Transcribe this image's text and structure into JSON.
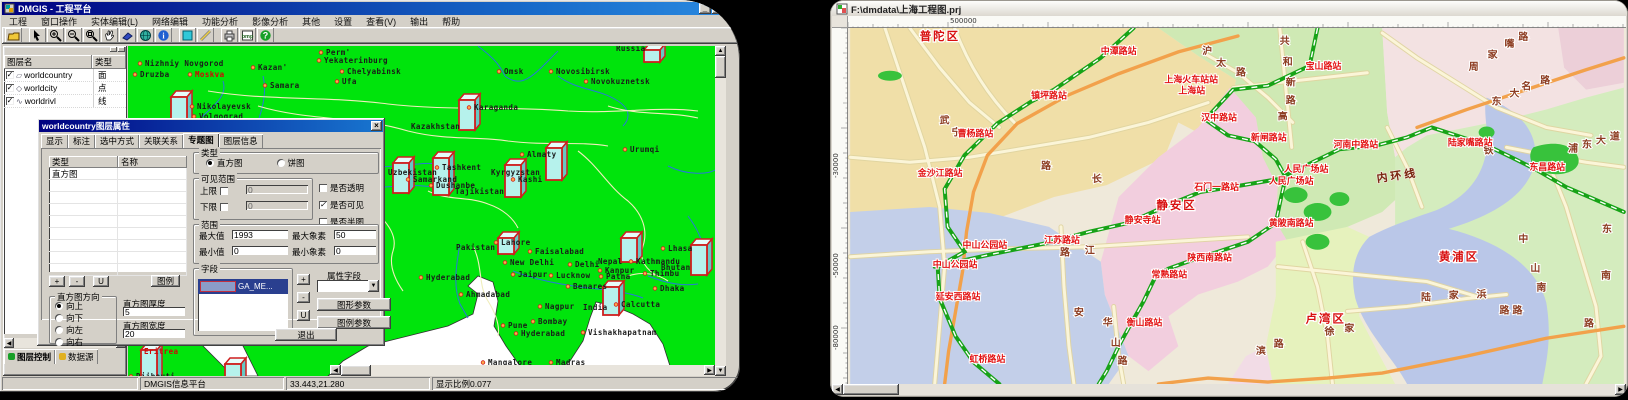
{
  "colors": {
    "land_green": "#00e40c",
    "titlebar_blue": "#000080",
    "station_red": "#e31212",
    "district_red": "#d80f0f",
    "metro_green": "#17a317",
    "orange_road": "#f2a14b",
    "column_cyan": "#b6f2ec",
    "column_border": "#cf1f1f"
  },
  "left_window": {
    "title": "DMGIS - 工程平台",
    "window_buttons": [
      "_",
      "□"
    ],
    "menus": [
      "工程",
      "窗口操作",
      "实体编辑(L)",
      "网络编辑",
      "功能分析",
      "影像分析",
      "其他",
      "设置",
      "查看(V)",
      "输出",
      "帮助"
    ],
    "toolbar_icons": [
      "open-folder",
      "select-arrow",
      "zoom-in",
      "zoom-out",
      "zoom-window",
      "pan-hand",
      "eraser-wedge",
      "globe",
      "info",
      "fill-rect",
      "measure-pencil",
      "print",
      "export-bmp",
      "help"
    ],
    "layer_panel": {
      "columns": [
        "图层名",
        "类型"
      ],
      "rows": [
        {
          "checked": true,
          "icon": "polygon-icon",
          "name": "worldcountry",
          "type": "面"
        },
        {
          "checked": true,
          "icon": "point-icon",
          "name": "worldcity",
          "type": "点"
        },
        {
          "checked": true,
          "icon": "line-icon",
          "name": "worldrivl",
          "type": "线"
        }
      ],
      "tabs": [
        {
          "label": "图层控制",
          "active": true
        },
        {
          "label": "数据源",
          "active": false
        }
      ]
    },
    "status": {
      "app": "DMGIS信息平台",
      "coords": "33.443,21.280",
      "scale": "显示比例0.077"
    },
    "dialog": {
      "title": "worldcountry图层属性",
      "close": "×",
      "tabs": [
        "显示",
        "标注",
        "选中方式",
        "关联关系",
        "专题图",
        "图层信息"
      ],
      "active_tab_index": 4,
      "list": {
        "col1": "类型",
        "col2": "名称",
        "row1": "直方图"
      },
      "type_group": {
        "label": "类型",
        "options": [
          "直方图",
          "饼图"
        ],
        "selected": 0
      },
      "visible_group": {
        "label": "可见范围",
        "upper": "上限",
        "lower": "下限",
        "upper_val": "0",
        "lower_val": "0"
      },
      "flags": [
        {
          "label": "是否透明",
          "checked": false
        },
        {
          "label": "是否可见",
          "checked": true
        },
        {
          "label": "是否半图",
          "checked": false
        }
      ],
      "range_group": {
        "label": "范围",
        "max_label": "最大值",
        "max_val": "1993",
        "maxpix_label": "最大象素",
        "maxpix_val": "50",
        "min_label": "最小值",
        "min_val": "0",
        "minpix_label": "最小象素",
        "minpix_val": "0"
      },
      "small_buttons": [
        "+",
        "-",
        "U"
      ],
      "legend_btn": "图例",
      "dir_group": {
        "label": "直方图方向",
        "options": [
          "向上",
          "向下",
          "向左",
          "向右"
        ],
        "selected": 0
      },
      "thickness": {
        "label": "直方图厚度",
        "val": "5"
      },
      "bar_width": {
        "label": "直方图宽度",
        "val": "20"
      },
      "field_group": {
        "label": "字段",
        "selected_item": "GA_ME..."
      },
      "field_buttons": [
        "+",
        "-",
        "U"
      ],
      "attr_field_label": "属性字段",
      "param_buttons": [
        "图形参数",
        "图例参数"
      ],
      "exit_btn": "退出"
    },
    "map": {
      "cities": [
        {
          "t": "Russia",
          "x": 488,
          "y": 5,
          "dot": false
        },
        {
          "t": "Nizhniy Novgorod",
          "x": 17,
          "y": 20,
          "dot": true
        },
        {
          "t": "Druzba",
          "x": 12,
          "y": 31,
          "dot": true
        },
        {
          "t": "Moskva",
          "x": 67,
          "y": 31,
          "dot": true,
          "red": true
        },
        {
          "t": "Kazan'",
          "x": 130,
          "y": 24,
          "dot": true
        },
        {
          "t": "Samara",
          "x": 142,
          "y": 42,
          "dot": true
        },
        {
          "t": "Perm'",
          "x": 198,
          "y": 9,
          "dot": true
        },
        {
          "t": "Yekaterinburg",
          "x": 196,
          "y": 17,
          "dot": true
        },
        {
          "t": "Chelyabinsk",
          "x": 219,
          "y": 28,
          "dot": true
        },
        {
          "t": "Ufa",
          "x": 214,
          "y": 38,
          "dot": true
        },
        {
          "t": "Nikolayevsk",
          "x": 69,
          "y": 63,
          "dot": true
        },
        {
          "t": "Volgograd",
          "x": 71,
          "y": 73,
          "dot": true
        },
        {
          "t": "Omsk",
          "x": 376,
          "y": 28,
          "dot": true
        },
        {
          "t": "Novosibirsk",
          "x": 428,
          "y": 28,
          "dot": true
        },
        {
          "t": "Novokuznetsk",
          "x": 463,
          "y": 38,
          "dot": true
        },
        {
          "t": "Karaganda",
          "x": 346,
          "y": 64,
          "dot": true
        },
        {
          "t": "Kazakhstan",
          "x": 283,
          "y": 83,
          "dot": false
        },
        {
          "t": "Almaty",
          "x": 399,
          "y": 111,
          "dot": true
        },
        {
          "t": "Urumqi",
          "x": 502,
          "y": 106,
          "dot": true
        },
        {
          "t": "Tashkent",
          "x": 314,
          "y": 124,
          "dot": true
        },
        {
          "t": "Samarkand",
          "x": 285,
          "y": 136,
          "dot": true
        },
        {
          "t": "Dushanbe",
          "x": 308,
          "y": 142,
          "dot": true
        },
        {
          "t": "Tajikistan",
          "x": 327,
          "y": 148,
          "dot": false
        },
        {
          "t": "Kyrgyzstan",
          "x": 363,
          "y": 129,
          "dot": false
        },
        {
          "t": "Kashi",
          "x": 390,
          "y": 136,
          "dot": true
        },
        {
          "t": "Uzbekistan",
          "x": 260,
          "y": 129,
          "dot": false
        },
        {
          "t": "Pakistan",
          "x": 328,
          "y": 204,
          "dot": false
        },
        {
          "t": "Lahore",
          "x": 373,
          "y": 199,
          "dot": true
        },
        {
          "t": "Faisalabad",
          "x": 407,
          "y": 208,
          "dot": true
        },
        {
          "t": "New Delhi",
          "x": 382,
          "y": 219,
          "dot": true
        },
        {
          "t": "Delhi",
          "x": 447,
          "y": 221,
          "dot": true
        },
        {
          "t": "Jaipur",
          "x": 390,
          "y": 231,
          "dot": true
        },
        {
          "t": "Lucknow",
          "x": 428,
          "y": 232,
          "dot": true
        },
        {
          "t": "Kanpur",
          "x": 477,
          "y": 227,
          "dot": true
        },
        {
          "t": "Patna",
          "x": 478,
          "y": 233,
          "dot": true
        },
        {
          "t": "Hyderabad",
          "x": 298,
          "y": 234,
          "dot": true
        },
        {
          "t": "Ahmadabad",
          "x": 338,
          "y": 251,
          "dot": true
        },
        {
          "t": "Nagpur",
          "x": 417,
          "y": 263,
          "dot": true
        },
        {
          "t": "India",
          "x": 455,
          "y": 264,
          "dot": false
        },
        {
          "t": "Calcutta",
          "x": 493,
          "y": 261,
          "dot": true
        },
        {
          "t": "Benares",
          "x": 445,
          "y": 243,
          "dot": true
        },
        {
          "t": "Bombay",
          "x": 410,
          "y": 278,
          "dot": true
        },
        {
          "t": "Pune",
          "x": 380,
          "y": 282,
          "dot": true
        },
        {
          "t": "Hyderabad",
          "x": 393,
          "y": 290,
          "dot": true
        },
        {
          "t": "Vishakhapatnam",
          "x": 460,
          "y": 289,
          "dot": true
        },
        {
          "t": "Mangalore",
          "x": 360,
          "y": 319,
          "dot": true
        },
        {
          "t": "Madras",
          "x": 428,
          "y": 319,
          "dot": true
        },
        {
          "t": "Bangalore",
          "x": 385,
          "y": 329,
          "dot": true
        },
        {
          "t": "Lhasa",
          "x": 540,
          "y": 205,
          "dot": true
        },
        {
          "t": "Bhutan",
          "x": 533,
          "y": 224,
          "dot": false
        },
        {
          "t": "Thimbu",
          "x": 522,
          "y": 230,
          "dot": true
        },
        {
          "t": "Dhaka",
          "x": 532,
          "y": 245,
          "dot": true
        },
        {
          "t": "Kathmandu",
          "x": 508,
          "y": 218,
          "dot": true
        },
        {
          "t": "Nepal",
          "x": 470,
          "y": 218,
          "dot": false
        },
        {
          "t": "Asmara",
          "x": 22,
          "y": 297,
          "dot": true
        },
        {
          "t": "Eritrea",
          "x": 16,
          "y": 308,
          "dot": false,
          "red": true
        },
        {
          "t": "Djibouti",
          "x": 8,
          "y": 333,
          "dot": true
        }
      ],
      "columns": [
        {
          "x": 43,
          "y": 51,
          "h": 33
        },
        {
          "x": 331,
          "y": 54,
          "h": 30
        },
        {
          "x": 305,
          "y": 112,
          "h": 37
        },
        {
          "x": 418,
          "y": 102,
          "h": 32
        },
        {
          "x": 377,
          "y": 119,
          "h": 32
        },
        {
          "x": 265,
          "y": 117,
          "h": 30
        },
        {
          "x": 493,
          "y": 192,
          "h": 24
        },
        {
          "x": 563,
          "y": 199,
          "h": 30
        },
        {
          "x": 475,
          "y": 241,
          "h": 28
        },
        {
          "x": 370,
          "y": 192,
          "h": 16
        },
        {
          "x": 516,
          "y": 4,
          "h": 12
        },
        {
          "x": 13,
          "y": 304,
          "h": 36
        },
        {
          "x": 97,
          "y": 318,
          "h": 22
        },
        {
          "x": 0,
          "y": 228,
          "h": 40,
          "w": 5
        }
      ]
    }
  },
  "right_window": {
    "title": "F:\\dmdata\\上海工程图.prj",
    "ruler": {
      "h_label": "500000",
      "h_label_x": 102,
      "v_labels": [
        {
          "t": "-30000",
          "y": 150
        },
        {
          "t": "-50000",
          "y": 250
        },
        {
          "t": "-80000",
          "y": 322
        }
      ]
    },
    "map": {
      "districts": [
        {
          "t": "普陀区",
          "x": 70,
          "y": 12
        },
        {
          "t": "静安区",
          "x": 308,
          "y": 182
        },
        {
          "t": "黄浦区",
          "x": 592,
          "y": 234
        },
        {
          "t": "卢湾区",
          "x": 458,
          "y": 296
        }
      ],
      "ring_labels": [
        {
          "t": "内环线",
          "x": 530,
          "y": 155
        }
      ],
      "stations": [
        {
          "t": "中潭路站",
          "x": 252,
          "y": 26
        },
        {
          "t": "镇坪路站",
          "x": 182,
          "y": 71
        },
        {
          "t": "曹杨路站",
          "x": 108,
          "y": 109
        },
        {
          "t": "金沙江路站",
          "x": 68,
          "y": 149
        },
        {
          "t": "中山公园站",
          "x": 113,
          "y": 221
        },
        {
          "t": "中山公园站",
          "x": 83,
          "y": 241
        },
        {
          "t": "延安西路站",
          "x": 86,
          "y": 273
        },
        {
          "t": "虹桥路站",
          "x": 120,
          "y": 336
        },
        {
          "t": "上海火车站站",
          "x": 316,
          "y": 55
        },
        {
          "t": "上海站",
          "x": 330,
          "y": 66
        },
        {
          "t": "汉中路站",
          "x": 353,
          "y": 93
        },
        {
          "t": "新闸路站",
          "x": 403,
          "y": 113
        },
        {
          "t": "宝山路站",
          "x": 458,
          "y": 41
        },
        {
          "t": "人民广场站",
          "x": 436,
          "y": 145
        },
        {
          "t": "人民广场站",
          "x": 421,
          "y": 157
        },
        {
          "t": "石门一路站",
          "x": 346,
          "y": 163
        },
        {
          "t": "黄陂南路站",
          "x": 421,
          "y": 199
        },
        {
          "t": "河南中路站",
          "x": 486,
          "y": 120
        },
        {
          "t": "陆家嘴路站",
          "x": 601,
          "y": 118
        },
        {
          "t": "东昌路站",
          "x": 683,
          "y": 143
        },
        {
          "t": "江苏路站",
          "x": 195,
          "y": 216
        },
        {
          "t": "静安寺站",
          "x": 276,
          "y": 196
        },
        {
          "t": "陕西南路站",
          "x": 339,
          "y": 234
        },
        {
          "t": "常熟路站",
          "x": 303,
          "y": 251
        },
        {
          "t": "衡山路站",
          "x": 278,
          "y": 299
        }
      ],
      "road_chars": [
        {
          "t": "沪",
          "x": 354,
          "y": 26
        },
        {
          "t": "太",
          "x": 368,
          "y": 38
        },
        {
          "t": "路",
          "x": 388,
          "y": 48
        },
        {
          "t": "共",
          "x": 432,
          "y": 16
        },
        {
          "t": "和",
          "x": 435,
          "y": 37
        },
        {
          "t": "新",
          "x": 438,
          "y": 58
        },
        {
          "t": "路",
          "x": 438,
          "y": 76
        },
        {
          "t": "高",
          "x": 430,
          "y": 92
        },
        {
          "t": "周",
          "x": 622,
          "y": 42
        },
        {
          "t": "家",
          "x": 641,
          "y": 30
        },
        {
          "t": "嘴",
          "x": 658,
          "y": 19
        },
        {
          "t": "路",
          "x": 672,
          "y": 12
        },
        {
          "t": "东",
          "x": 645,
          "y": 77
        },
        {
          "t": "大",
          "x": 663,
          "y": 69
        },
        {
          "t": "名",
          "x": 675,
          "y": 62
        },
        {
          "t": "路",
          "x": 694,
          "y": 56
        },
        {
          "t": "浦",
          "x": 722,
          "y": 124
        },
        {
          "t": "东",
          "x": 736,
          "y": 120
        },
        {
          "t": "大",
          "x": 750,
          "y": 116
        },
        {
          "t": "道",
          "x": 764,
          "y": 112
        },
        {
          "t": "东",
          "x": 756,
          "y": 205
        },
        {
          "t": "南",
          "x": 755,
          "y": 252
        },
        {
          "t": "路",
          "x": 738,
          "y": 300
        },
        {
          "t": "中",
          "x": 672,
          "y": 215
        },
        {
          "t": "山",
          "x": 684,
          "y": 245
        },
        {
          "t": "南",
          "x": 690,
          "y": 264
        },
        {
          "t": "路",
          "x": 666,
          "y": 287
        },
        {
          "t": "陆",
          "x": 574,
          "y": 274
        },
        {
          "t": "家",
          "x": 602,
          "y": 272
        },
        {
          "t": "浜",
          "x": 630,
          "y": 271
        },
        {
          "t": "路",
          "x": 653,
          "y": 287
        },
        {
          "t": "铁",
          "x": 637,
          "y": 126
        },
        {
          "t": "武",
          "x": 90,
          "y": 96
        },
        {
          "t": "宁",
          "x": 102,
          "y": 108
        },
        {
          "t": "长",
          "x": 243,
          "y": 155
        },
        {
          "t": "路",
          "x": 192,
          "y": 142
        },
        {
          "t": "安",
          "x": 225,
          "y": 289
        },
        {
          "t": "华",
          "x": 254,
          "y": 299
        },
        {
          "t": "山",
          "x": 262,
          "y": 320
        },
        {
          "t": "路",
          "x": 269,
          "y": 338
        },
        {
          "t": "江",
          "x": 236,
          "y": 227
        },
        {
          "t": "路",
          "x": 211,
          "y": 229
        },
        {
          "t": "滨",
          "x": 408,
          "y": 328
        },
        {
          "t": "路",
          "x": 426,
          "y": 321
        },
        {
          "t": "徐",
          "x": 477,
          "y": 308
        },
        {
          "t": "家",
          "x": 497,
          "y": 305
        }
      ]
    }
  }
}
